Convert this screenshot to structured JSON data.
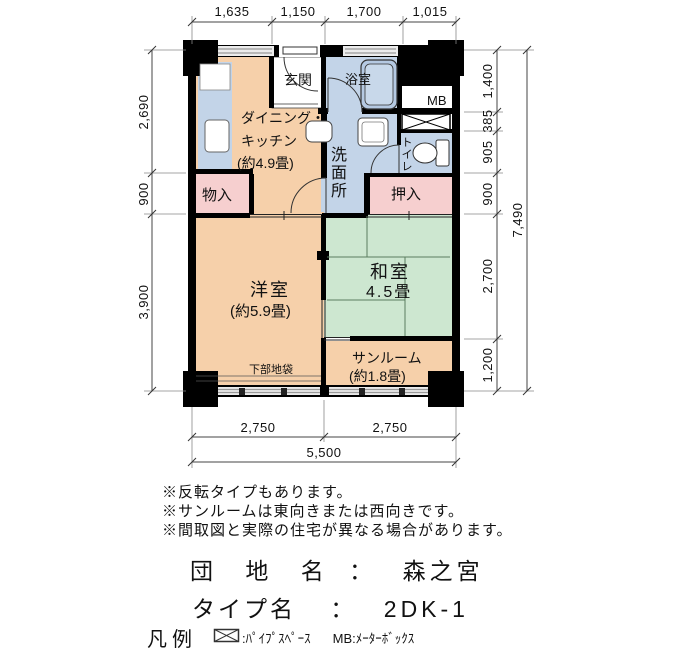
{
  "plan": {
    "dimensions": {
      "top": [
        "1,635",
        "1,150",
        "1,700",
        "1,015"
      ],
      "left": [
        "2,690",
        "900",
        "3,900"
      ],
      "right": [
        "1,400",
        "385",
        "905",
        "900",
        "2,700",
        "1,200"
      ],
      "right_total": "7,490",
      "bottom": [
        "2,750",
        "2,750"
      ],
      "bottom_total": "5,500"
    },
    "rooms": {
      "dining_kitchen": {
        "line1": "ダイニング・",
        "line2": "キッチン",
        "size": "(約4.9畳)"
      },
      "entrance": {
        "label": "玄関"
      },
      "bathroom": {
        "label": "浴室"
      },
      "meter_box": {
        "label": "MB"
      },
      "washroom": {
        "label": "洗面所"
      },
      "toilet": {
        "label": "トイレ"
      },
      "closet_small": {
        "label": "物入"
      },
      "closet_futon": {
        "label": "押入"
      },
      "western_room": {
        "label": "洋室",
        "size": "(約5.9畳)"
      },
      "japanese_room": {
        "label": "和室",
        "size": "4.5畳"
      },
      "sunroom": {
        "label": "サンルーム",
        "size": "(約1.8畳)"
      },
      "lower_cabinet": {
        "label": "下部地袋"
      }
    }
  },
  "notes": [
    "※反転タイプもあります。",
    "※サンルームは東向きまたは西向きです。",
    "※間取図と実際の住宅が異なる場合があります。"
  ],
  "property": {
    "estate_label": "団 地 名",
    "estate_sep": "：",
    "estate_name": "森之宮",
    "type_label": "タイプ名",
    "type_sep": "：",
    "type_name": "2DK-1"
  },
  "legend": {
    "title": "凡例",
    "pipe_space": ":ﾊﾟｲﾌﾟｽﾍﾟｰｽ",
    "meter_box": "MB:ﾒｰﾀｰﾎﾞｯｸｽ"
  },
  "colors": {
    "room_peach": "#f6d0aa",
    "wet_blue": "#c3d4e8",
    "tatami_green": "#cde7d0",
    "closet_pink": "#f6cfcf",
    "wall": "#000000"
  }
}
